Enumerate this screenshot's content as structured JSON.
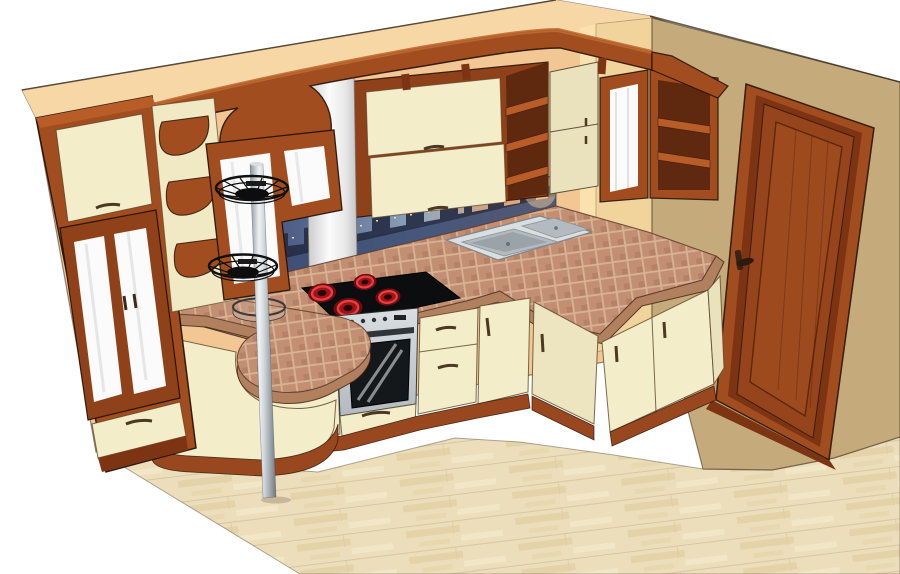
{
  "meta": {
    "kind": "3d-kitchen-interior-render",
    "width_px": 900,
    "height_px": 574
  },
  "palette": {
    "background": "#ffffff",
    "wall": "#f2c794",
    "soffit": "#f8d7a7",
    "wall_right": "#c5aa7b",
    "pillar": "#f1d49c",
    "pillar_side": "#f9e2ae",
    "wood": "#a24d20",
    "wood_mid": "#8f411a",
    "wood_dark": "#7c3413",
    "wood_deep": "#5f2910",
    "wood_light": "#b85c28",
    "plinth": "#98471e",
    "cream": "#f3edca",
    "cream_dark": "#e9e2bc",
    "glass": "#fbfbfb",
    "steel_light": "#d9dee1",
    "steel_mid": "#b3bbc0",
    "steel_dark": "#8a9094",
    "black_glass": "#0c0d0f",
    "burner_dark": "#6f0c12",
    "burner_mid": "#a01319",
    "burner_bright": "#e8403f",
    "counter_tile": "#c28f73",
    "counter_grout": "#d9b294",
    "counter_edge": "#b1805f",
    "floor": "#ecdeba",
    "floor_streak": "#e0cb9e",
    "floor_hi": "#f6eccf",
    "sky_left": "#36406c",
    "sky_mid": "#93a8bf",
    "sky_right": "#efae74",
    "building": "#252e44",
    "water": "#3e4f74",
    "window_light": "#ffd98a",
    "chrome_hi": "#eef2f4",
    "chrome_lo": "#73797e",
    "ink": "#2e2013"
  },
  "scene": {
    "objects": [
      "back-wall",
      "soffit-band",
      "right-wall",
      "wall-pillar",
      "laminate-floor",
      "panel-door",
      "door-handle",
      "tall-cabinet",
      "tall-cabinet-glass-doors",
      "tall-cabinet-drawer",
      "corner-corbel-shelves",
      "bar-glass-screen",
      "wavy-wood-cornice",
      "curved-bar-shelf",
      "range-hood-duct",
      "range-hood",
      "upper-cabinet-flip-doors",
      "upper-open-shelves",
      "corner-upper-cabinet",
      "frosted-corner-door",
      "wall-shelf-box",
      "city-skyline-backsplash",
      "tiled-countertop",
      "peninsula-counter",
      "counter-pole-ring",
      "chrome-pole",
      "wire-basket-upper",
      "wire-basket-lower",
      "black-cooktop",
      "red-burners",
      "stainless-oven",
      "oven-drawer",
      "double-sink",
      "base-drawer-units",
      "base-door-cabinets",
      "corner-base-cabinet",
      "right-wing-cabinets",
      "wood-plinth"
    ]
  }
}
